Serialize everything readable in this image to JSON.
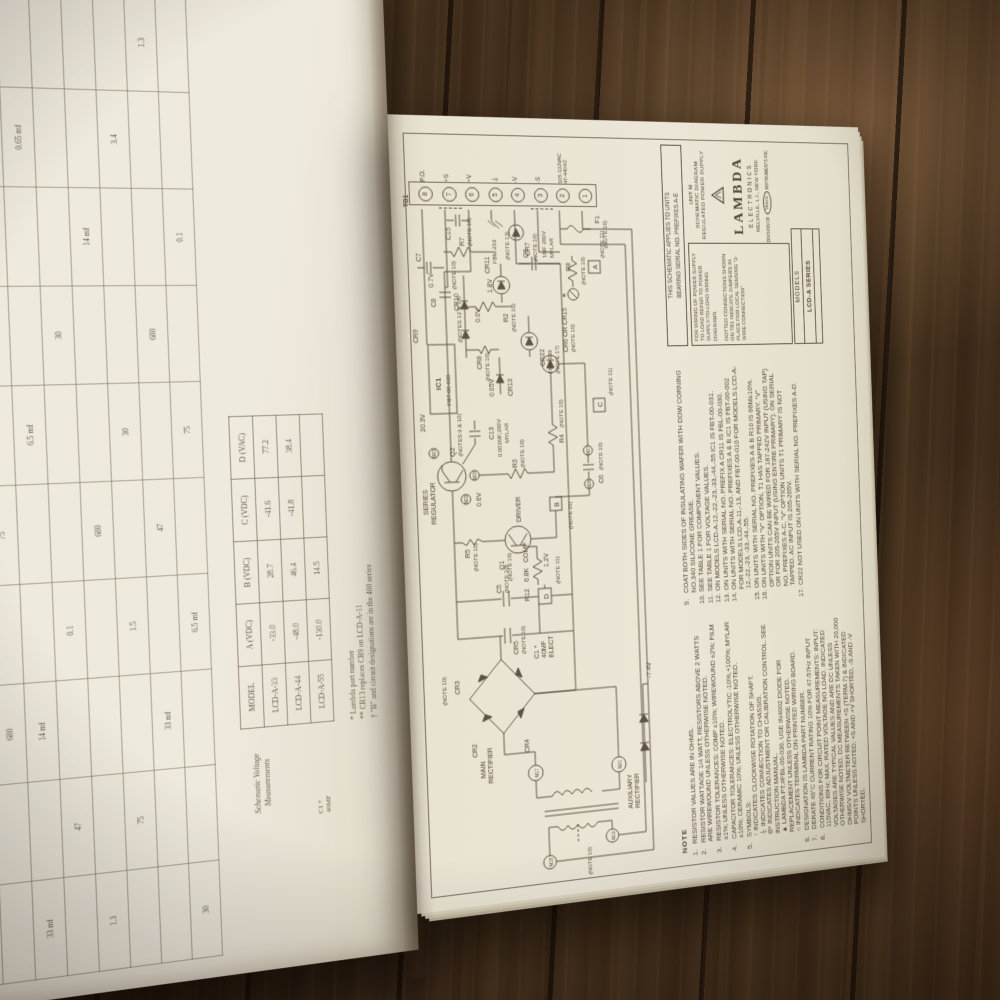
{
  "right": {
    "tb1": {
      "name": "TB1",
      "terminals": [
        {
          "n": "8",
          "l": "P.O."
        },
        {
          "n": "7",
          "l": "+S"
        },
        {
          "n": "6",
          "l": "+V"
        },
        {
          "n": "5",
          "l": "⏚"
        },
        {
          "n": "4",
          "l": "-V"
        },
        {
          "n": "3",
          "l": "-S"
        },
        {
          "n": "2",
          "l": ""
        },
        {
          "n": "1",
          "l": ""
        }
      ],
      "ac_line1": "105-132VAC",
      "ac_line2": "47-440HZ"
    },
    "applies": {
      "l1": "THIS SCHEMATIC APPLIES TO UNITS",
      "l2": "BEARING SERIAL NO. PREFIXES A-E"
    },
    "wiring": {
      "p1": "FOR WIRING OF POWER SUPPLY TO LOAD REFER TO POWER SUPPLY-TO-LOAD WIRING DIAGRAMS",
      "p2": "DOTTED CONNECTIONS SHOWN ON TB1 INDICATE JUMPERS IN PLACE FOR LOCAL SENSING \"2-WIRE CONNECTION\""
    },
    "models": {
      "label": "MODELS",
      "value": "LCD-A SERIES"
    },
    "title": {
      "unit": "UNIT M",
      "l1": "SCHEMATIC DIAGRAM",
      "l2": "REGULATED POWER SUPPLY",
      "brand": "LAMBDA",
      "sub": "ELECTRONICS",
      "city": "MELVILLE, L.I., NEW YORK",
      "div1": "DIVISION OF",
      "veeco": "Veeco",
      "div2": "INSTRUMENTS INC."
    },
    "notes_heading": "NOTE",
    "notes1": [
      {
        "n": "1.",
        "t": "RESISTOR VALUES ARE IN OHMS."
      },
      {
        "n": "2.",
        "t": "RESISTOR WATTAGE 1/4 WATT, RESISTORS ABOVE 2 WATTS ARE WIREWOUND UNLESS OTHERWISE NOTED."
      },
      {
        "n": "3.",
        "t": "RESISTOR TOLERANCES: COMP ±10%; WIREWOUND ±2%; FILM ±1%; UNLESS OTHERWISE NOTED."
      },
      {
        "n": "4.",
        "t": "CAPACITOR TOLERANCES: ELECTROLYTIC -10%,+100%; MYLAR ±10%; CERAMIC 10%; UNLESS OTHERWISE NOTED."
      },
      {
        "n": "5.",
        "t": "SYMBOLS:\n↑  INDICATES CLOCKWISE ROTATION OF SHAFT.\n⏚  INDICATES CONNECTION TO CHASSIS.\n⊘* INDICATES ADJUSTMENT OR CALIBRATION CONTROL. SEE INSTRUCTION MANUAL.\n▲  LAMBDA PT.#FBL-00-030, USE IN4002 DIODE FOR REPLACEMENT UNLESS OTHERWISE NOTED.\n○  INDICATES TERMINAL ON PRINTED WIRING BOARD."
      },
      {
        "n": "6.",
        "t": "DESIGNATION IS  LAMBDA PART NUMBER."
      },
      {
        "n": "7.",
        "t": "DERATE 40°C CURRENT RATING 10% FOR 47-57Hz INPUT"
      },
      {
        "n": "8.",
        "t": "CONDITIONS FOR CIRCUIT POINT MEASUREMENTS: INPUT: 115VAC, 60Hz; MAX. RATED VOLTAGE NO LOAD. INDICATED VOLTAGES ARE TYPICAL VALUES AND ARE DC UNLESS OTHERWISE NOTED. DC MEASUREMENTS TAKEN WITH 20,000 OHMS/V VOLTMETER BETWEEN +S (TERM.7) & INDICATED POINTS UNLESS NOTED; +S AND +V SHORTED, -S AND -V SHORTED."
      }
    ],
    "notes2": [
      {
        "n": "9.",
        "t": "COAT BOTH SIDES OF INSULATING WAFER WITH DOW CORNING NO.340 SILICONE GREASE."
      },
      {
        "n": "10.",
        "t": "SEE TABLE 1 FOR COMPONENT VALUES."
      },
      {
        "n": "11.",
        "t": "SEE TABLE 1 FOR VOLTAGE VALUES."
      },
      {
        "n": "12.",
        "t": "ON MODELS LCD-A-12,-22,-23,-33,-44,-55 IC1 IS FBT-00-031."
      },
      {
        "n": "13.",
        "t": "ON UNITS WITH SERIAL NO. PREFIX A CR11 IS FBL-00-030."
      },
      {
        "n": "14.",
        "t": "ON UNITS WITH SERIAL NO. PREFIXES A & B IC1 IS FBT-00-002 FOR MODELS LCD-A-11,-13, AND FBT-00-010 FOR MODELS LCD-A-12,-22,-23, -33,-44,-55."
      },
      {
        "n": "15.",
        "t": "ON UNITS WITH SERIAL NO. PREFIXES A & B R10 IS 66M±10%."
      },
      {
        "n": "16.",
        "t": "ON UNITS WITH \"V\" OPTION, T1 HAS TAPPED PRIMARY. \"V\" OPTION UNITS CAN BE WIRED FOR 187-242V INPUT (USING TAP) OR FOR 205-265V INPUT (USING ENTIRE PRIMARY). ON SERIAL NO. PREFIXES A-C, \"V\" OPTION UNITS T1 PRIMARY IS NOT TAPPED. AC INPUT IS 205-265V."
      },
      {
        "n": "17.",
        "t": "CR22 NOT USED ON UNITS WITH SERIAL NO. PREFIXES A-D."
      }
    ],
    "sch": {
      "mr1": "MAIN",
      "mr2": "RECTIFIER",
      "ar1": "AUXILIARY",
      "ar2": "RECTIFIER",
      "note16": "(NOTE 16)",
      "m17": "M17",
      "m21": "M21",
      "m18": "M18",
      "m19": "M19",
      "m20": "M20",
      "m22": "M22",
      "m23": "M23",
      "m26": "M26",
      "m27": "M27",
      "cr2": "CR2",
      "cr3": "CR3",
      "cr4": "CR4",
      "cr5": "CR5",
      "n10a": "(NOTE 10)",
      "n10b": "(NOTE 10)",
      "c1": "C1 *",
      "c1v": "40MF",
      "c1t": "ELECT",
      "c5": "C5",
      "c5n": "(NOTE 10)",
      "d": "D",
      "dn": "(NOTE 11)",
      "b": "B",
      "bn": "(NOTE 11)",
      "cbox": "C",
      "cn": "(NOTE 11)",
      "abox": "A",
      "an": "(NOTE 11)",
      "q1": "Q1",
      "q1n": "(NOTE 10)",
      "q1t": "DRIVER",
      "q2": "Q2",
      "q2n": "(NOTES 9 & 10)",
      "sr1": "SERIES",
      "sr2": "REGULATOR",
      "r2": "R2",
      "rn2": "(NOTE 10)",
      "r3": "R3",
      "rn3": "(NOTE 10)",
      "r4": "R4",
      "rn4": "(NOTE 10)",
      "r5": "R5",
      "rn5": "(NOTE 10)",
      "r7": "R7",
      "rn7": "(NOTE 10)",
      "r8": "R8",
      "rn8": "(NOTE 10)",
      "r12": "R12",
      "r12v": "6.8K",
      "r12t": "COMP",
      "c6": "C6",
      "c6n": "(NOTE 10)",
      "c7": "C7",
      "c8": "C8",
      "c8n": "(NOTE 10)",
      "c9": "C9",
      "c9v": "1MF 200V",
      "c9t": "MYLAR",
      "c13": "C13",
      "c13v": "0.001MF,200V",
      "c13t": "MYLAR",
      "c15": "C15",
      "cr615": "CR6 OR CR15",
      "cr615n": "(NOTE 10)",
      "ic1": "IC1",
      "ic1p": "FBT-00-030",
      "ic1n": "(NOTES 12 & 14)",
      "cr7": "CR7",
      "cr7n": "(NOTE 10)",
      "cr8": "CR8",
      "cr8n": "(NOTE 10)",
      "cr9": "CR9",
      "cr10": "CR10",
      "cr13": "CR13",
      "cr22": "CR22",
      "cr22p": "FBM-039",
      "cr22n": "(NOTE 17)",
      "cr11": "CR11",
      "cr11p": "FBM-219",
      "cr11n": "(NOTE 13)",
      "f1": "F1",
      "f1n": "(NOTE 10)",
      "adj": "∗",
      "v203": "20.3V",
      "v06": "0.6V",
      "v12": "1.2V",
      "v005": "0.05V",
      "v00": "0.0V",
      "v18": "1.8V",
      "v07": "0.7V",
      "v74": "-7.4V"
    }
  },
  "left": {
    "grid_rows": [
      [
        "",
        "1.3",
        "",
        "30",
        "",
        "",
        "1.5",
        "",
        "",
        ""
      ],
      [
        "",
        "",
        "680",
        "",
        "75",
        "",
        "",
        "3.4",
        "",
        ""
      ],
      [
        "33 mf",
        "",
        "14 mf",
        "",
        "",
        "6.5 mf",
        "",
        "",
        "0.65 mf",
        ""
      ],
      [
        "",
        "47",
        "",
        "0.1",
        "",
        "",
        "30",
        "",
        "",
        ""
      ],
      [
        "1.3",
        "",
        "",
        "",
        "680",
        "",
        "",
        "14 mf",
        "",
        ""
      ],
      [
        "",
        "75",
        "",
        "1.5",
        "",
        "30",
        "",
        "",
        "3.4",
        ""
      ],
      [
        "",
        "",
        "33 mf",
        "",
        "47",
        "",
        "680",
        "",
        "",
        "1.3"
      ],
      [
        "30",
        "",
        "",
        "6.5 mf",
        "",
        "75",
        "",
        "0.1",
        "",
        ""
      ]
    ],
    "vt": {
      "t1": "Schematic Voltage",
      "t2": "Measurements",
      "headers": [
        "MODEL",
        "A (VDC)",
        "B (VDC)",
        "C (VDC)",
        "D (VAC)"
      ],
      "rows": [
        [
          "LCD-A-33",
          "-33.0",
          "28.7",
          "-41.6",
          "77.2"
        ],
        [
          "LCD-A-44",
          "-48.0",
          "46.4",
          "-41.8",
          "38.4"
        ],
        [
          "LCD-A-55",
          "-130.0",
          "14.5",
          "",
          ""
        ]
      ]
    },
    "footnotes": [
      "*  Lambda part number",
      "** CR13 replaces CR9 on LCD-A-11",
      "†  \"B\" and circuit designations are in the 400 series"
    ],
    "cap": {
      "c1": "C1 *",
      "v": "40MF"
    }
  }
}
